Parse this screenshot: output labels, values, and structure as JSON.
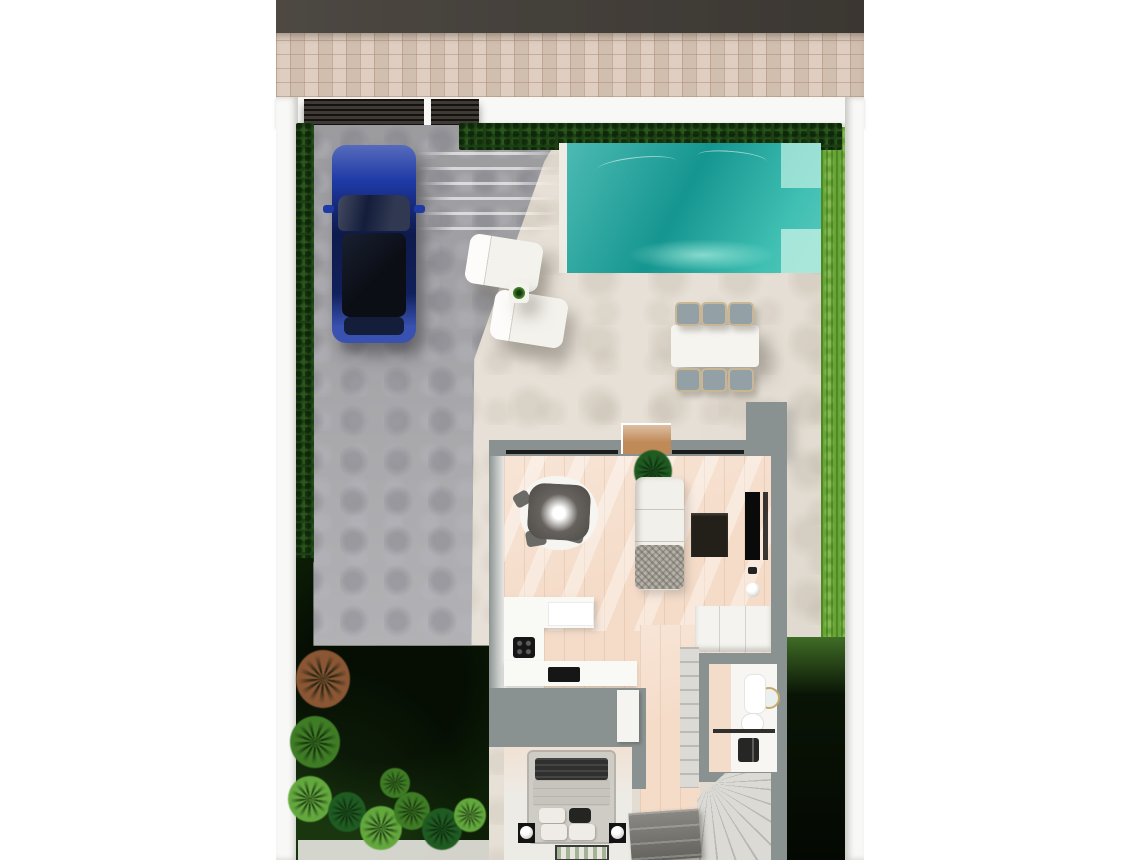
{
  "scene": {
    "kind": "3d-floorplan-render-top-view",
    "rooms": [
      "street",
      "sidewalk",
      "driveway",
      "pool-terrace",
      "living-room",
      "kitchen",
      "hallway",
      "bedroom",
      "bathroom",
      "stairs",
      "garden-southwest",
      "lawn-east"
    ],
    "objects": [
      "boundary-wall",
      "entrance-gate",
      "hedge",
      "car",
      "swimming-pool",
      "pool-steps",
      "sun-loungers",
      "lounger-side-table",
      "outdoor-dining-table",
      "outdoor-chairs",
      "indoor-dining-table",
      "pendant-light",
      "indoor-chairs",
      "potted-plant",
      "sofa",
      "tv-cabinet",
      "tv-screen",
      "floor-lamp",
      "kitchen-counters",
      "cooktop",
      "closet",
      "bed",
      "pillows",
      "nightstand-lamps",
      "bedroom-rug",
      "bathroom-mirror",
      "bathroom-sink",
      "toilet",
      "shower",
      "winder-stairs",
      "stair-storage",
      "palm-plants",
      "bushes"
    ]
  },
  "colors": {
    "page": "#ffffff",
    "street": "#433e38",
    "sidewalk": "#d9c6b6",
    "wall": "#f8f8f6",
    "gate": "#2c2924",
    "hedge": "#1d4113",
    "lawn": "#68a534",
    "garden": "#13280b",
    "garden_dark": "#0d2007",
    "driveway": "#a7a7ab",
    "terrace": "#e7e0d6",
    "pool": "#1aa79e",
    "pool_steps": "#b9ece1",
    "curb": "#efece5",
    "car_body": "#1e3aa6",
    "car_glass": "#141d3a",
    "car_roof": "#0b0e15",
    "house_wall": "#8a9291",
    "wall_light": "#e8e8e5",
    "floor_wood": "#f5dcc9",
    "floor_bedroom": "#edebe5",
    "counter": "#f9f9f6",
    "appliance": "#161616",
    "sofa": "#f2f0ea",
    "throw": "#b5b1a9",
    "table_indoor": "#68645f",
    "chair_indoor": "#6a6a67",
    "chair_seat": "#93a0a6",
    "chair_frame": "#c9b695",
    "tv": "#0a0a0a",
    "cabinet": "#232019",
    "lintel": "#c08a58",
    "closet": "#f4f3ef",
    "bath_floor": "#f7f6f3",
    "bath_wall": "#f4dccb",
    "mirror_ring": "#c9a96b",
    "fixture": "#262624",
    "stairs": "#dcdad5",
    "stairs_dark": "#7a7872",
    "bed_frame": "#cfccc6",
    "bed_throw": "#30302f",
    "bed_duvet": "#c7c4be",
    "pillow": "#efece7",
    "pillow_dark": "#242423",
    "rug_bed": "#e8e6df",
    "walkway": "#e9e7e1",
    "lounger": "#f4f2ec",
    "outdoor_table": "#f6f4ef",
    "rug_round": "#f7f5f1",
    "plant_dark": "#1f5c22",
    "plant_mid": "#3f7d25",
    "plant_bright": "#63a83d",
    "palm_rust": "#8a5634"
  }
}
